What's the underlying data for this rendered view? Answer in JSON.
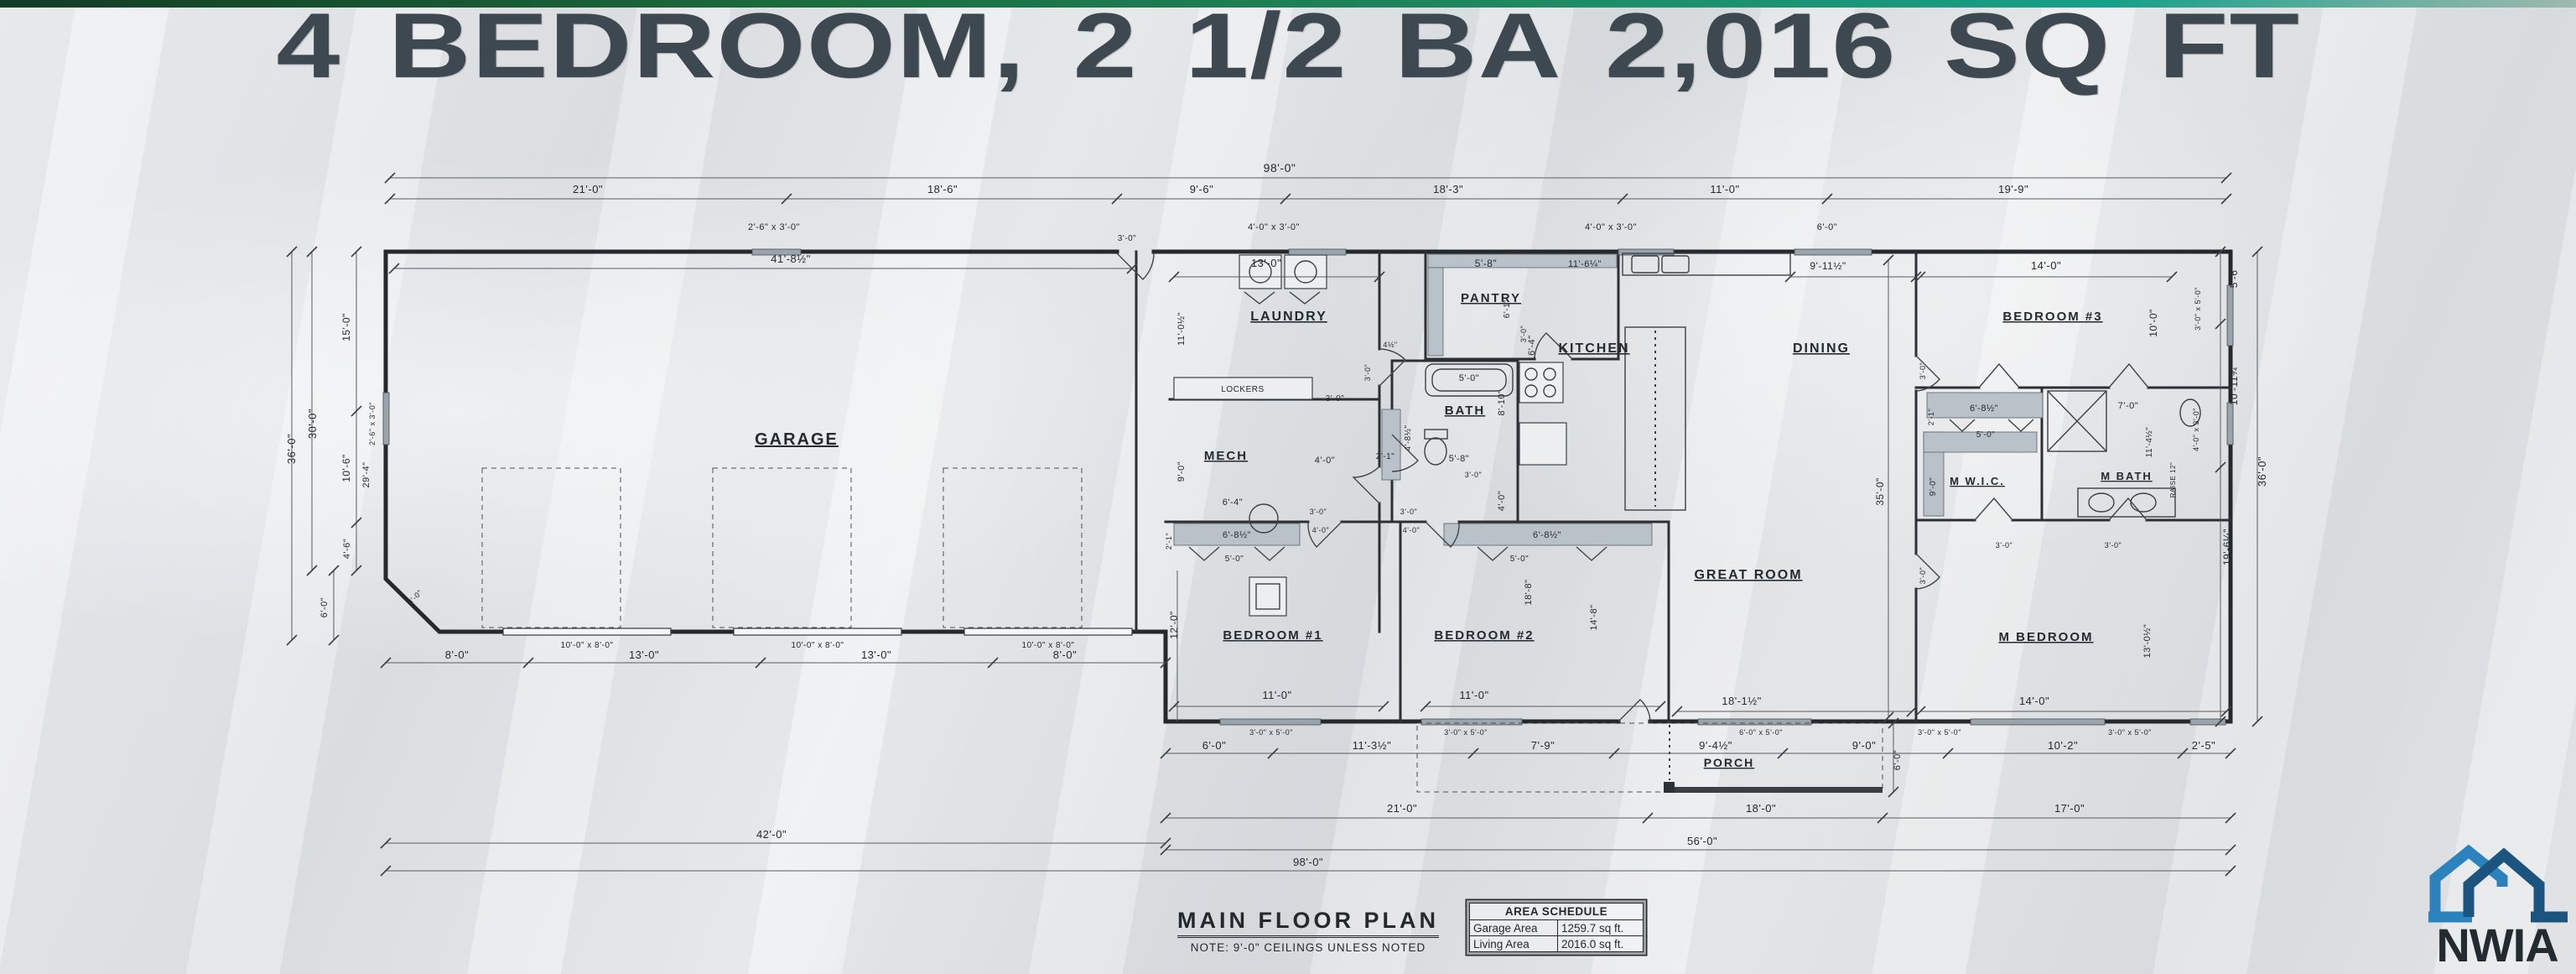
{
  "banner": {
    "title": "4 BEDROOM, 2 1/2 BA 2,016 SQ FT"
  },
  "floor_plan": {
    "rooms": {
      "garage": "GARAGE",
      "laundry": "LAUNDRY",
      "mech": "MECH",
      "pantry": "PANTRY",
      "kitchen": "KITCHEN",
      "dining": "DINING",
      "bath": "BATH",
      "bedroom3": "BEDROOM #3",
      "mwic": "M W.I.C.",
      "mbath": "M BATH",
      "great_room": "GREAT ROOM",
      "bedroom1": "BEDROOM #1",
      "bedroom2": "BEDROOM #2",
      "mbedroom": "M BEDROOM",
      "porch": "PORCH",
      "lockers": "LOCKERS"
    },
    "dims": {
      "d98": "98'-0\"",
      "d56": "56'-0\"",
      "d42": "42'-0\"",
      "d41_8h": "41'-8½\"",
      "d36": "36'-0\"",
      "d35": "35'-0\"",
      "d30": "30'-0\"",
      "d29_4": "29'-4\"",
      "d21": "21'-0\"",
      "d19_9": "19'-9\"",
      "d19_6q": "19'-6¼\"",
      "d18_8": "18'-8\"",
      "d18_6": "18'-6\"",
      "d18_3": "18'-3\"",
      "d18_1h": "18'-1½\"",
      "d18": "18'-0\"",
      "d17": "17'-0\"",
      "d16_4": "16'-4\"",
      "d15": "15'-0\"",
      "d14_8": "14'-8\"",
      "d14": "14'-0\"",
      "d13_0h": "13'-0½\"",
      "d13": "13'-0\"",
      "d12": "12'-0\"",
      "d11_6q": "11'-6¼\"",
      "d11_4h": "11'-4½\"",
      "d11_3h": "11'-3½\"",
      "d11_0h": "11'-0½\"",
      "d11": "11'-0\"",
      "d10_11t": "10'-11¾\"",
      "d10_6": "10'-6\"",
      "d10_2": "10'-2\"",
      "d10": "10'-0\"",
      "d9_11h": "9'-11½\"",
      "d9_6": "9'-6\"",
      "d9_4h": "9'-4½\"",
      "d9": "9'-0\"",
      "d8_10": "8'-10\"",
      "d8": "8'-0\"",
      "d7_9": "7'-9\"",
      "d7": "7'-0\"",
      "d6_8h": "6'-8½\"",
      "d6_4": "6'-4\"",
      "d6_1": "6'-1\"",
      "d6": "6'-0\"",
      "d5_8": "5'-8\"",
      "d5_6": "5'-6\"",
      "d5": "5'-0\"",
      "d4_8h": "4'-8½\"",
      "d4_6": "4'-6\"",
      "d4h": "4½\"",
      "d4": "4'-0\"",
      "d3": "3'-0\"",
      "d2_5": "2'-5\"",
      "d2_1": "2'-1\"",
      "raise": "RAISE 12\"",
      "w26x3": "2'-6\" x 3'-0\"",
      "w4x3": "4'-0\" x 3'-0\"",
      "w3x5": "3'-0\" x 5'-0\"",
      "w6x5": "6'-0\" x 5'-0\"",
      "w10x8": "10'-0\" x 8'-0\""
    }
  },
  "footer": {
    "plan_title": "MAIN FLOOR PLAN",
    "plan_note": "NOTE: 9'-0\" CEILINGS UNLESS NOTED"
  },
  "area_schedule": {
    "title": "AREA SCHEDULE",
    "rows": [
      {
        "label": "Garage Area",
        "value": "1259.7 sq ft."
      },
      {
        "label": "Living Area",
        "value": "2016.0 sq ft."
      }
    ]
  },
  "logo": {
    "name": "NWIA"
  },
  "colors": {
    "title_text": "#3e4850",
    "strip_green": "#1b6b3c",
    "logo_light_blue": "#2c82bd",
    "logo_dark_blue": "#1c5480",
    "plan_ink": "#26292c"
  }
}
